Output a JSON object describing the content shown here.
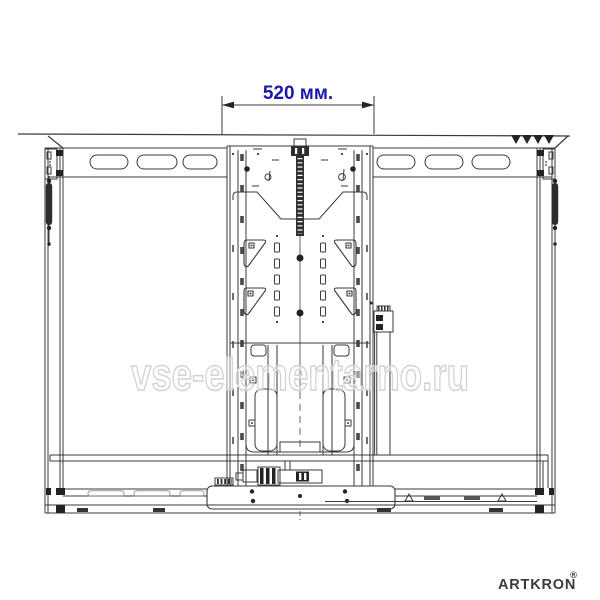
{
  "page": {
    "background": "#ffffff"
  },
  "dimension": {
    "label": "520 мм.",
    "color": "#1a18ad"
  },
  "watermark": {
    "text": "vse-elementarno.ru",
    "outline_color": "#d2d2d2"
  },
  "brand": {
    "name": "ARTKRON",
    "registered": "®",
    "color": "#3a3a3a"
  },
  "drawing": {
    "line_color": "#3a3a3a",
    "dark_fill": "#232323"
  }
}
